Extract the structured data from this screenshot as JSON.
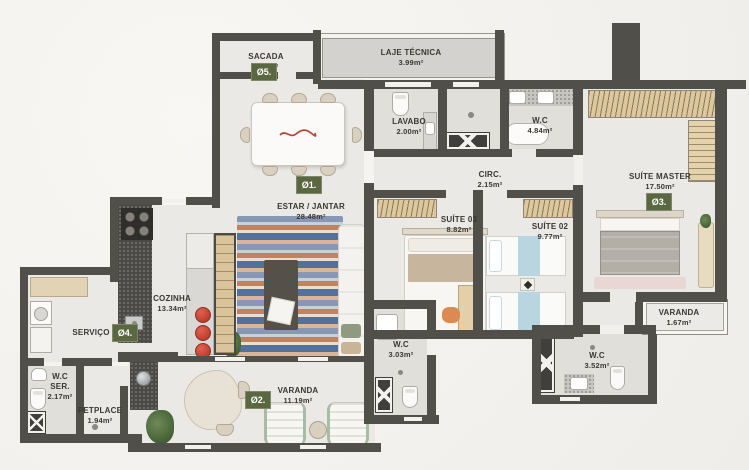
{
  "plan": {
    "rooms": [
      {
        "name": "SACADA",
        "area": "3.32m²"
      },
      {
        "name": "LAJE TÉCNICA",
        "area": "3.99m²"
      },
      {
        "name": "LAVABO",
        "area": "2.00m²"
      },
      {
        "name": "W.C",
        "area": "4.84m²"
      },
      {
        "name": "CIRC.",
        "area": "2.15m²"
      },
      {
        "name": "SUÍTE MASTER",
        "area": "17.50m²"
      },
      {
        "name": "ESTAR / JANTAR",
        "area": "28.48m²"
      },
      {
        "name": "SUÍTE 03",
        "area": "8.82m²"
      },
      {
        "name": "SUÍTE 02",
        "area": "9.77m²"
      },
      {
        "name": "COZINHA",
        "area": "13.34m²"
      },
      {
        "name": "SERVIÇO",
        "area": ""
      },
      {
        "name": "W.C SER.",
        "area": "2.17m²"
      },
      {
        "name": "PETPLACE",
        "area": "1.94m²"
      },
      {
        "name": "VARANDA",
        "area": "11.19m²"
      },
      {
        "name": "W.C",
        "area": "3.03m²"
      },
      {
        "name": "W.C",
        "area": "3.52m²"
      },
      {
        "name": "VARANDA",
        "area": "1.67m²"
      }
    ],
    "markers": [
      {
        "label": "Ø1."
      },
      {
        "label": "Ø2."
      },
      {
        "label": "Ø3."
      },
      {
        "label": "Ø4."
      },
      {
        "label": "Ø5."
      }
    ],
    "colors": {
      "wall": "#514f49",
      "floor": "#eae9e6",
      "marker_green": "#5a6741",
      "stool_red": "#c8473a",
      "bed_blue": "#b9d6e0",
      "wood_tan": "#dcc79e",
      "label_text": "#3a3833"
    }
  }
}
